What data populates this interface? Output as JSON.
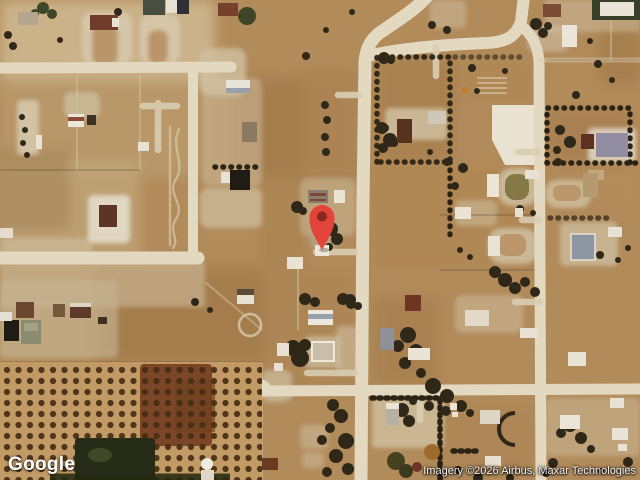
{
  "footer": {
    "logo": "Google",
    "attribution": "Imagery ©2026 Airbus, Maxar Technologies"
  },
  "pin": {
    "color": "#E2443A",
    "inner_color": "#8A281D"
  },
  "colors": {
    "terrain_base": "#b28b5b",
    "road": "#e3d8c0",
    "trees": "#2f2718",
    "orchard": "#c29a66"
  }
}
